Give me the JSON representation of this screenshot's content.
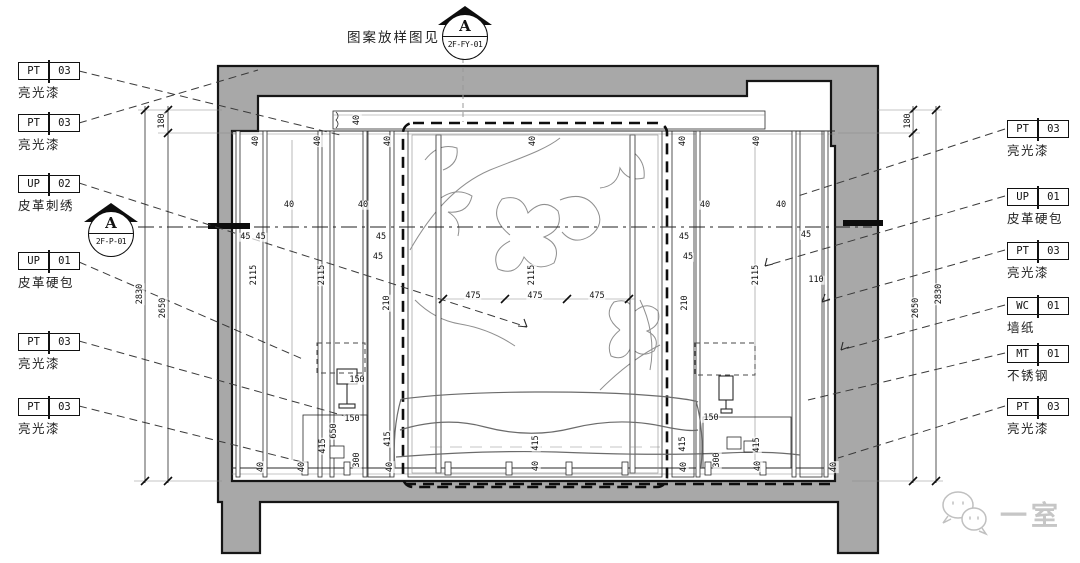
{
  "top_note": {
    "text": "图案放样图见"
  },
  "top_marker": {
    "letter": "A",
    "code": "2F-FY-01"
  },
  "left_marker": {
    "letter": "A",
    "code": "2F-P-01"
  },
  "left_labels": [
    {
      "code": "PT",
      "num": "03",
      "name": "亮光漆"
    },
    {
      "code": "PT",
      "num": "03",
      "name": "亮光漆"
    },
    {
      "code": "UP",
      "num": "02",
      "name": "皮革刺绣"
    },
    {
      "code": "UP",
      "num": "01",
      "name": "皮革硬包"
    },
    {
      "code": "PT",
      "num": "03",
      "name": "亮光漆"
    },
    {
      "code": "PT",
      "num": "03",
      "name": "亮光漆"
    }
  ],
  "right_labels": [
    {
      "code": "PT",
      "num": "03",
      "name": "亮光漆"
    },
    {
      "code": "UP",
      "num": "01",
      "name": "皮革硬包"
    },
    {
      "code": "PT",
      "num": "03",
      "name": "亮光漆"
    },
    {
      "code": "WC",
      "num": "01",
      "name": "墙纸"
    },
    {
      "code": "MT",
      "num": "01",
      "name": "不锈钢"
    },
    {
      "code": "PT",
      "num": "03",
      "name": "亮光漆"
    }
  ],
  "watermark": {
    "text": "一室"
  },
  "colors": {
    "wall_fill": "#a8a8a8",
    "line": "#161616",
    "leader": "#3a3a3a",
    "pattern": "#8f8f8f",
    "wm": "#c6c6c6"
  },
  "dims": [
    {
      "t": "180",
      "x": 162,
      "y": 121,
      "r": -90
    },
    {
      "t": "2830",
      "x": 140,
      "y": 294,
      "r": -90
    },
    {
      "t": "2650",
      "x": 163,
      "y": 308,
      "r": -90
    },
    {
      "t": "180",
      "x": 908,
      "y": 121,
      "r": -90
    },
    {
      "t": "2650",
      "x": 916,
      "y": 308,
      "r": -90
    },
    {
      "t": "2830",
      "x": 939,
      "y": 294,
      "r": -90
    },
    {
      "t": "40",
      "x": 256,
      "y": 141,
      "r": -90
    },
    {
      "t": "40",
      "x": 318,
      "y": 141,
      "r": -90
    },
    {
      "t": "40",
      "x": 388,
      "y": 141,
      "r": -90
    },
    {
      "t": "40",
      "x": 533,
      "y": 141,
      "r": -90
    },
    {
      "t": "40",
      "x": 683,
      "y": 141,
      "r": -90
    },
    {
      "t": "40",
      "x": 757,
      "y": 141,
      "r": -90
    },
    {
      "t": "40",
      "x": 357,
      "y": 120,
      "r": -90
    },
    {
      "t": "40",
      "x": 289,
      "y": 205,
      "r": 0
    },
    {
      "t": "40",
      "x": 363,
      "y": 205,
      "r": 0
    },
    {
      "t": "40",
      "x": 705,
      "y": 205,
      "r": 0
    },
    {
      "t": "40",
      "x": 781,
      "y": 205,
      "r": 0
    },
    {
      "t": "45 45",
      "x": 253,
      "y": 237,
      "r": 0
    },
    {
      "t": "45",
      "x": 381,
      "y": 237,
      "r": 0
    },
    {
      "t": "45",
      "x": 378,
      "y": 257,
      "r": 0
    },
    {
      "t": "45",
      "x": 684,
      "y": 237,
      "r": 0
    },
    {
      "t": "45",
      "x": 688,
      "y": 257,
      "r": 0
    },
    {
      "t": "45",
      "x": 806,
      "y": 235,
      "r": 0
    },
    {
      "t": "210",
      "x": 387,
      "y": 303,
      "r": -90
    },
    {
      "t": "210",
      "x": 685,
      "y": 303,
      "r": -90
    },
    {
      "t": "110",
      "x": 816,
      "y": 280,
      "r": 0
    },
    {
      "t": "2115",
      "x": 254,
      "y": 275,
      "r": -90
    },
    {
      "t": "2115",
      "x": 322,
      "y": 275,
      "r": -90
    },
    {
      "t": "2115",
      "x": 532,
      "y": 275,
      "r": -90
    },
    {
      "t": "2115",
      "x": 756,
      "y": 275,
      "r": -90
    },
    {
      "t": "475",
      "x": 473,
      "y": 296,
      "r": 0
    },
    {
      "t": "475",
      "x": 535,
      "y": 296,
      "r": 0
    },
    {
      "t": "475",
      "x": 597,
      "y": 296,
      "r": 0
    },
    {
      "t": "150",
      "x": 357,
      "y": 380,
      "r": 0
    },
    {
      "t": "150",
      "x": 352,
      "y": 419,
      "r": 0
    },
    {
      "t": "650",
      "x": 334,
      "y": 431,
      "r": -90
    },
    {
      "t": "415",
      "x": 323,
      "y": 446,
      "r": -90
    },
    {
      "t": "300",
      "x": 357,
      "y": 460,
      "r": -90
    },
    {
      "t": "150",
      "x": 711,
      "y": 418,
      "r": 0
    },
    {
      "t": "415",
      "x": 757,
      "y": 445,
      "r": -90
    },
    {
      "t": "300",
      "x": 717,
      "y": 460,
      "r": -90
    },
    {
      "t": "415",
      "x": 536,
      "y": 443,
      "r": -90
    },
    {
      "t": "40",
      "x": 536,
      "y": 466,
      "r": -90
    },
    {
      "t": "415",
      "x": 388,
      "y": 439,
      "r": -90
    },
    {
      "t": "415",
      "x": 683,
      "y": 444,
      "r": -90
    },
    {
      "t": "40",
      "x": 261,
      "y": 467,
      "r": -90
    },
    {
      "t": "40",
      "x": 302,
      "y": 467,
      "r": -90
    },
    {
      "t": "40",
      "x": 390,
      "y": 467,
      "r": -90
    },
    {
      "t": "40",
      "x": 684,
      "y": 467,
      "r": -90
    },
    {
      "t": "40",
      "x": 758,
      "y": 466,
      "r": -90
    },
    {
      "t": "40",
      "x": 834,
      "y": 467,
      "r": -90
    }
  ]
}
